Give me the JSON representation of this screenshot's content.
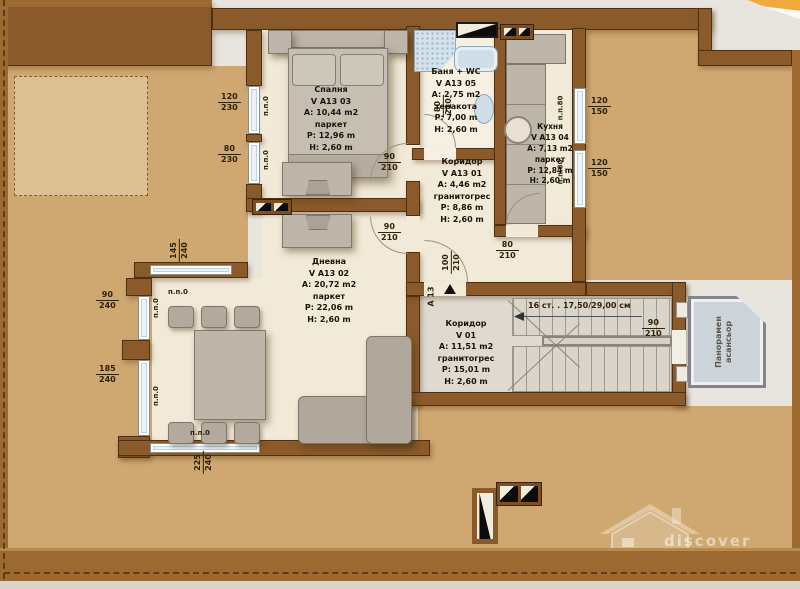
{
  "rooms": {
    "bedroom": {
      "name": "Спалня",
      "id": "V A13 03",
      "area": "A: 10,44 m2",
      "floor": "паркет",
      "perimeter": "P: 12,96 m",
      "height": "H: 2,60 m"
    },
    "bath": {
      "name": "Баня + WC",
      "id": "V A13 05",
      "area": "A: 2,75 m2",
      "floor": "теракота",
      "perimeter": "P: 7,00 m",
      "height": "H: 2,60 m"
    },
    "kitchen": {
      "name": "Кухня",
      "id": "V A13 04",
      "area": "A: 7,13 m2",
      "floor": "паркет",
      "perimeter": "P: 12,84 m",
      "height": "H: 2,60 m"
    },
    "hall": {
      "name": "Коридор",
      "id": "V A13 01",
      "area": "A: 4,46 m2",
      "floor": "гранитогрес",
      "perimeter": "P: 8,86 m",
      "height": "H: 2,60 m"
    },
    "living": {
      "name": "Дневна",
      "id": "V A13 02",
      "area": "A: 20,72 m2",
      "floor": "паркет",
      "perimeter": "P: 22,06 m",
      "height": "H: 2,60 m"
    },
    "lobby": {
      "name": "Коридор",
      "id": "V 01",
      "area": "A: 11,51 m2",
      "floor": "гранитогрес",
      "perimeter": "P: 15,01 m",
      "height": "H: 2,60 m"
    }
  },
  "stairs": {
    "label": "16 ст. . 17,50/29,00 см"
  },
  "elevator": {
    "line1": "Панорамен",
    "line2": "асансьор"
  },
  "entrance": {
    "label": "A 13"
  },
  "pp": {
    "zero": "п.п.0",
    "eighty": "п.п.80"
  },
  "dims": {
    "bw1": {
      "w": "120",
      "h": "230"
    },
    "bw2": {
      "w": "80",
      "h": "230"
    },
    "lw1": {
      "w": "90",
      "h": "240"
    },
    "lw2": {
      "w": "185",
      "h": "240"
    },
    "lw3": {
      "w": "145",
      "h": "240"
    },
    "lw4": {
      "w": "225",
      "h": "240"
    },
    "kw1": {
      "w": "120",
      "h": "150"
    },
    "kw2": {
      "w": "120",
      "h": "150"
    },
    "d_bedroom": {
      "w": "90",
      "h": "210"
    },
    "d_living": {
      "w": "90",
      "h": "210"
    },
    "d_kitchen": {
      "w": "80",
      "h": "210"
    },
    "d_entrance": {
      "w": "100",
      "h": "210"
    },
    "d_bath": {
      "w": "80",
      "h": "210"
    },
    "d_lobby": {
      "w": "90",
      "h": "210"
    }
  },
  "watermark": {
    "tagline": "discover Bulgaria",
    "brand": {
      "b1": "B",
      "b2": "EST",
      "b3": "BGP",
      "b4": "ROPERTIES"
    }
  }
}
